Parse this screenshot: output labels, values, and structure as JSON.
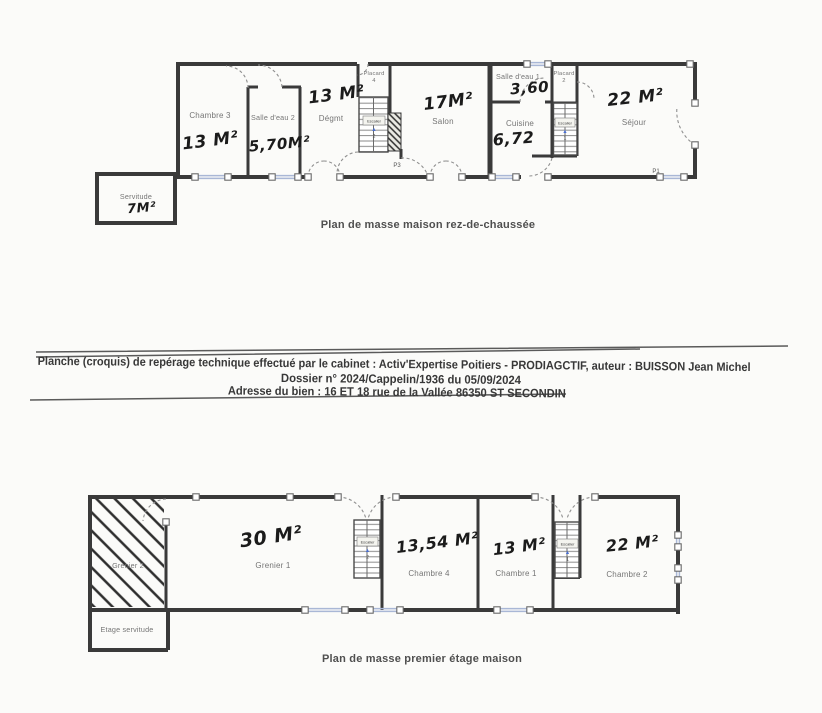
{
  "floor1": {
    "caption": "Plan de masse maison rez-de-chaussée",
    "rooms": {
      "chambre3": {
        "label": "Chambre 3",
        "area": "13 M²"
      },
      "salle_eau2": {
        "label": "Salle d'eau 2",
        "area": "5,70M²"
      },
      "degmt": {
        "label": "Dégmt",
        "area": "13 M²"
      },
      "placard4": {
        "label": "Placard",
        "num": "4"
      },
      "salon": {
        "label": "Salon",
        "area": "17M²"
      },
      "salle_eau1": {
        "label": "Salle d'eau 1",
        "area": "3,60"
      },
      "placard2": {
        "label": "Placard",
        "num": "2"
      },
      "cuisine": {
        "label": "Cuisine",
        "area": "6,72"
      },
      "sejour": {
        "label": "Séjour",
        "area": "22 M²"
      },
      "servitude": {
        "label": "Servitude",
        "area": "7M²"
      }
    },
    "stairs": {
      "left": {
        "label": "Escalier",
        "num": "2"
      },
      "right": {
        "label": "Escalier",
        "num": "1"
      }
    },
    "doors": {
      "p3": "P3",
      "p1": "P1"
    }
  },
  "report_block": {
    "line1": "Planche (croquis) de repérage technique effectué par le cabinet : Activ'Expertise Poitiers - PRODIAGCTIF, auteur : BUISSON Jean Michel",
    "line2": "Dossier n° 2024/Cappelin/1936 du 05/09/2024",
    "line3": "Adresse du bien : 16 ET 18 rue de la Vallée 86350 ST SECONDIN"
  },
  "floor2": {
    "caption": "Plan de masse premier étage maison",
    "rooms": {
      "grenier2": {
        "label": "Grenier 2"
      },
      "etage_servitude": {
        "label": "Etage servitude"
      },
      "grenier1": {
        "label": "Grenier 1",
        "area": "30 M²"
      },
      "chambre4": {
        "label": "Chambre 4",
        "area": "13,54 M²"
      },
      "chambre1": {
        "label": "Chambre 1",
        "area": "13 M²"
      },
      "chambre2": {
        "label": "Chambre 2",
        "area": "22 M²"
      }
    },
    "stairs": {
      "left": {
        "label": "Escalier",
        "num": "2"
      },
      "right": {
        "label": "Escalier",
        "num": "1"
      }
    }
  },
  "colors": {
    "wall": "#3a3a3a",
    "window": "#a9b7d6",
    "room_label": "#757575",
    "handwriting": "#1b1b1b",
    "stair_arrow": "#4a6fd0"
  }
}
